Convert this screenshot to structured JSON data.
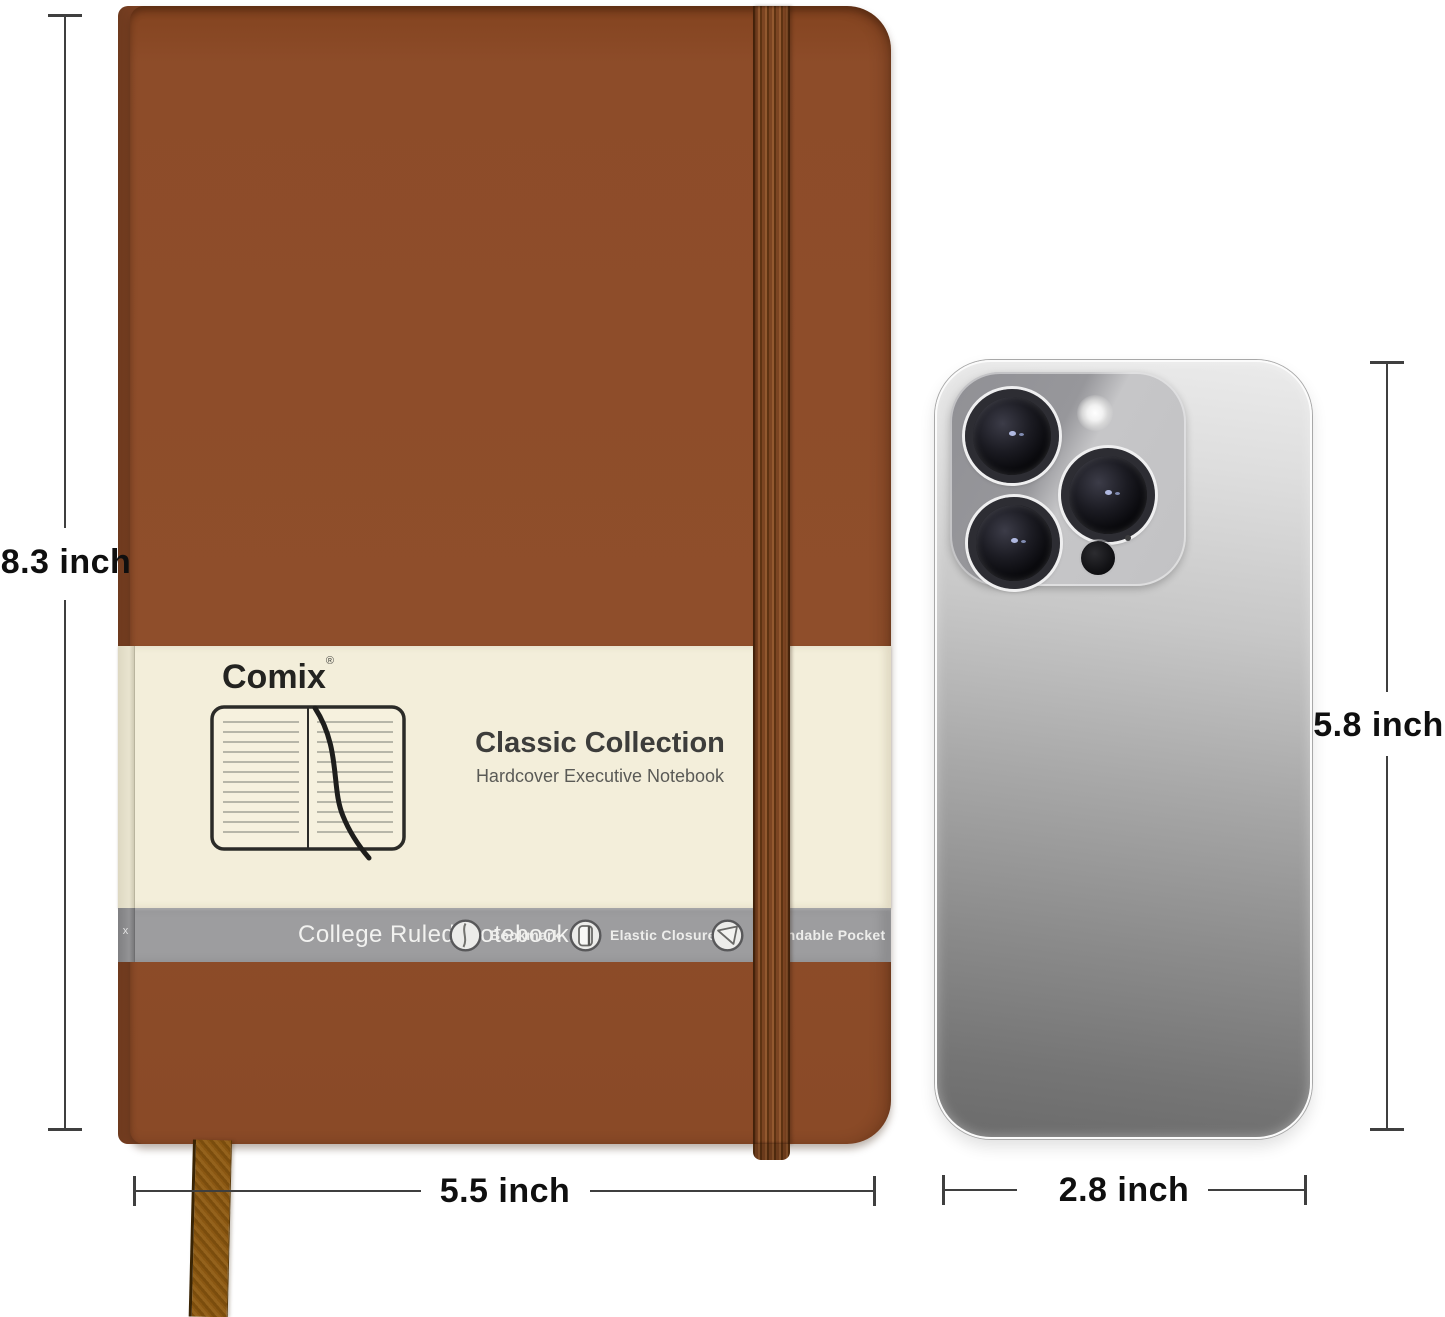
{
  "product": {
    "brand": "Comix",
    "registered_mark": "®",
    "title": "Classic Collection",
    "subtitle": "Hardcover Executive Notebook",
    "info_band": {
      "side_text": "x",
      "label": "College Ruled Notebook",
      "features": [
        {
          "icon": "bookmark-icon",
          "label": "Bookmark"
        },
        {
          "icon": "elastic-closure-icon",
          "label": "Elastic Closure"
        },
        {
          "icon": "pocket-icon",
          "label": "Expandable Pocket"
        }
      ]
    }
  },
  "dimensions": {
    "notebook_height": "8.3 inch",
    "notebook_width": "5.5 inch",
    "phone_height": "5.8 inch",
    "phone_width": "2.8 inch"
  },
  "colors": {
    "notebook_brown": "#8d4c29",
    "notebook_spine": "#7a4023",
    "elastic_band": "#7c4522",
    "belly_band_cream": "#f3eeda",
    "info_band_gray": "#9d9d9f",
    "ribbon_gold": "#94621c",
    "phone_silver_light": "#ebebeb",
    "phone_silver_dark": "#6b6b6b",
    "dimension_line": "#3f3f3f"
  }
}
